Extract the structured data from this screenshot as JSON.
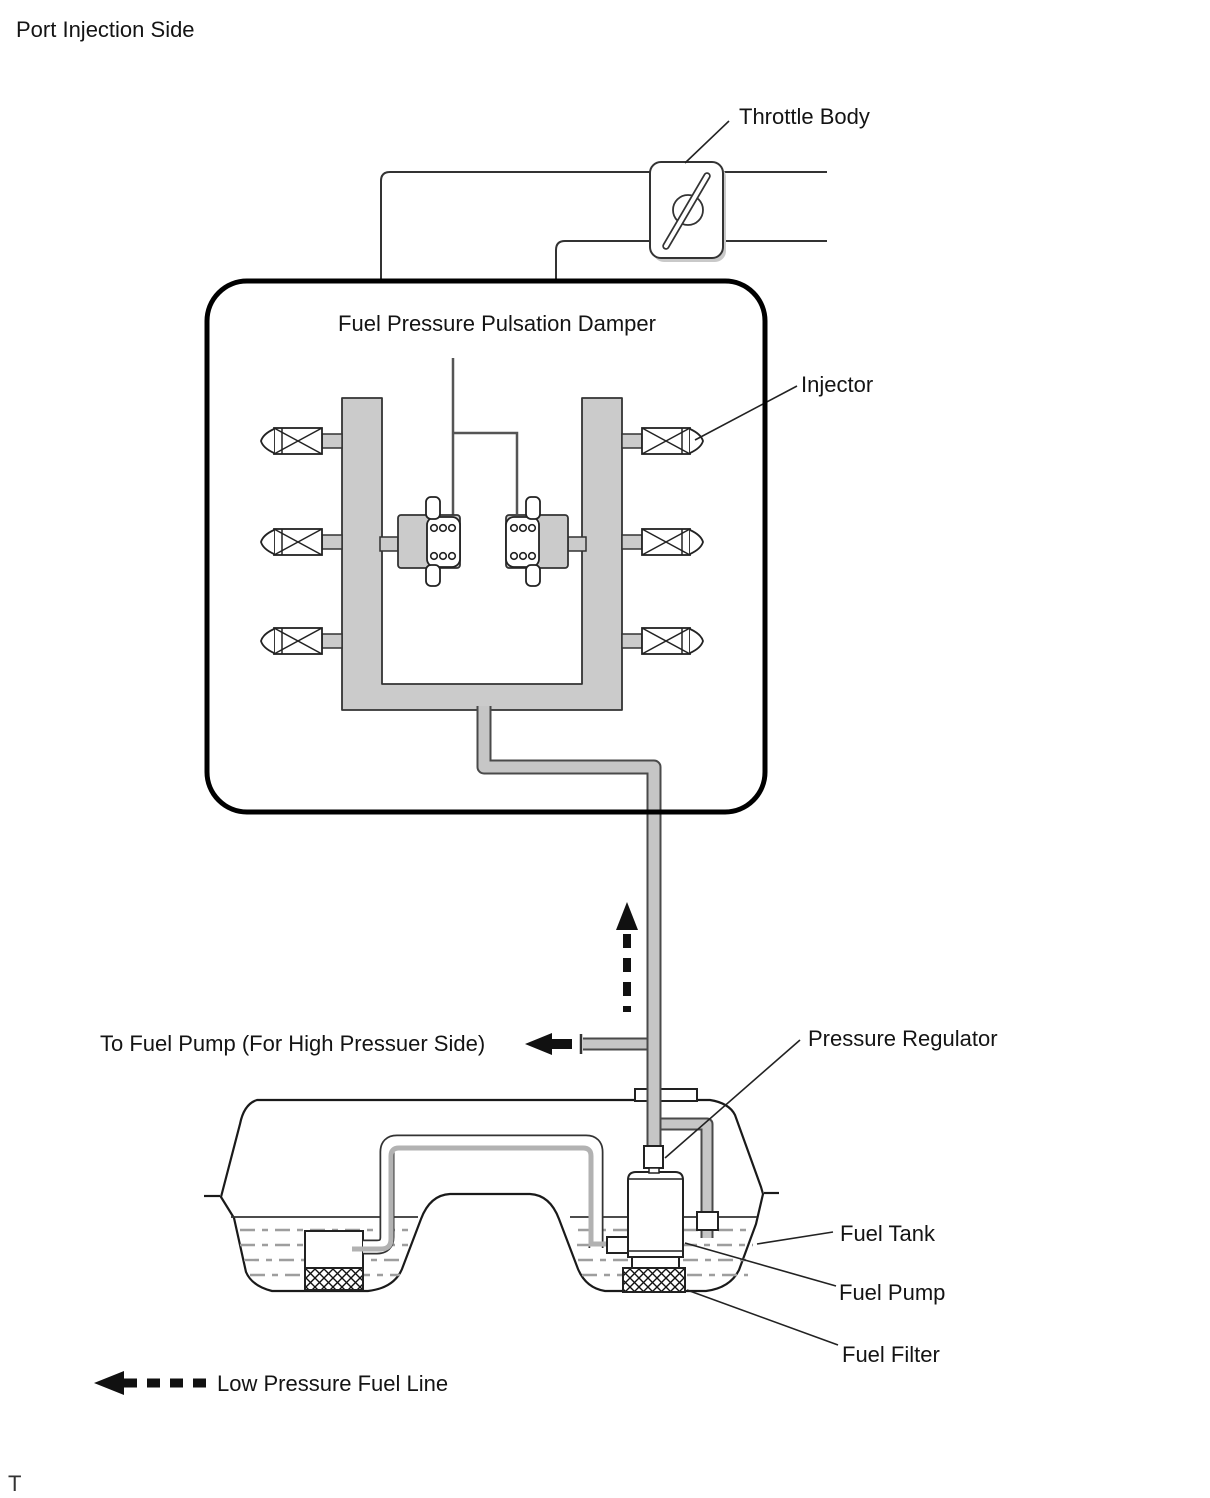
{
  "page": {
    "title": "Port Injection Side",
    "footnote": "T",
    "background": "#ffffff"
  },
  "diagram": {
    "damper_box_title": "Fuel Pressure Pulsation Damper",
    "labels": {
      "throttle_body": "Throttle Body",
      "injector": "Injector",
      "to_fuel_pump": "To Fuel Pump (For High Pressuer Side)",
      "pressure_regulator": "Pressure Regulator",
      "fuel_tank": "Fuel Tank",
      "fuel_pump": "Fuel Pump",
      "fuel_filter": "Fuel Filter"
    },
    "legend": {
      "low_pressure_fuel_line": "Low Pressure Fuel Line"
    },
    "counts": {
      "injectors": 6,
      "pulsation_dampers": 2
    },
    "icons": {
      "throttle_body": "butterfly-valve-in-rounded-rect",
      "injector": "crossed-box-with-pointed-tip",
      "flow_direction": "dashed-up-arrow",
      "low_pressure_line": "dashed-left-arrow"
    },
    "colors": {
      "rail_gray": "#cbcbcb",
      "pipe_core_gray": "#c6c6c6",
      "pipe_edge_gray": "#4a4a4a",
      "inner_pipe_gray": "#b2b2b2",
      "line_black": "#1a1a1a",
      "dash_gray": "#9e9e9e"
    }
  }
}
